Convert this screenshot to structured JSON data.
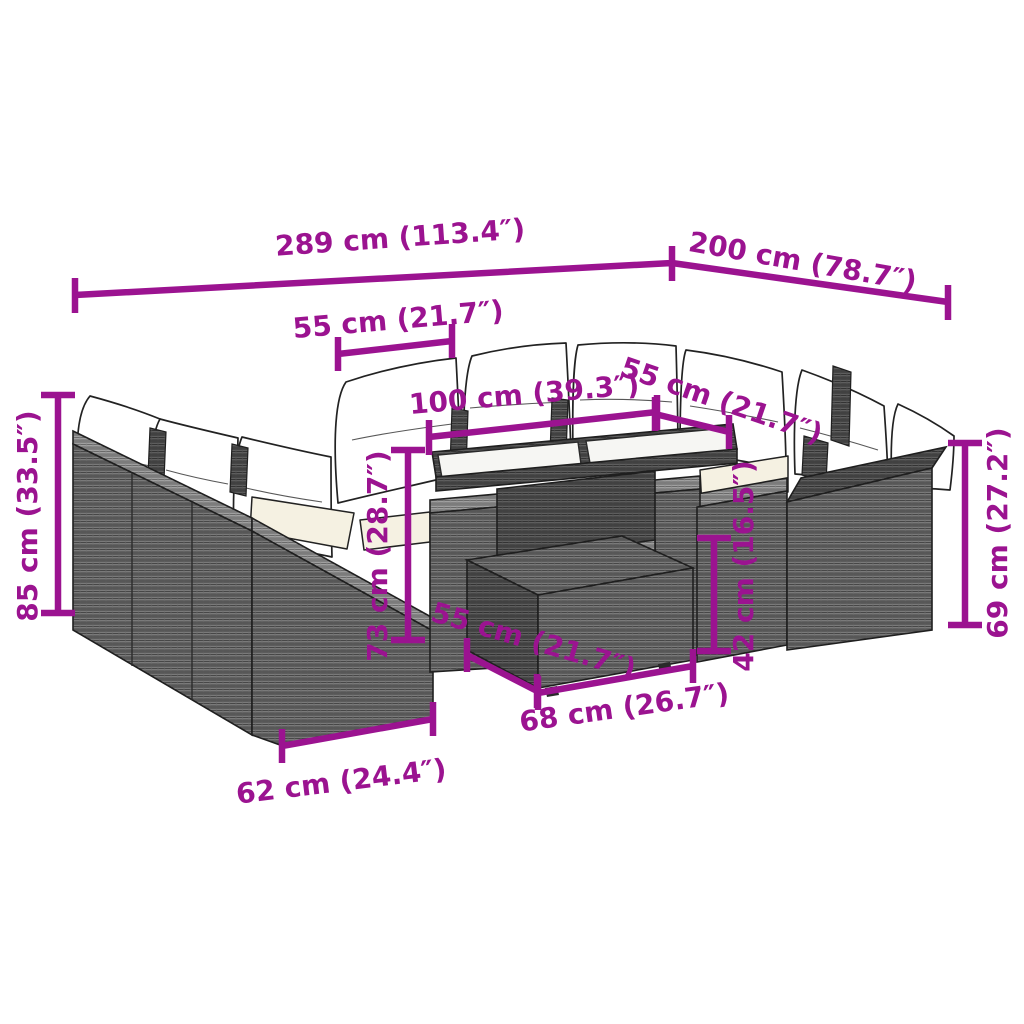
{
  "figure": {
    "subject": "Garden lounge furniture set dimension diagram"
  },
  "colors": {
    "dimension": "#9B1390",
    "background": "#ffffff",
    "outline": "#1f1f1f",
    "rattan_dark": "#4f4f4f",
    "rattan_mid": "#676767",
    "rattan_light": "#8d8d8d",
    "cushion_white": "#ffffff",
    "cushion_cream": "#f5f1e2",
    "glass": "#f6f6f3"
  },
  "dimensions": {
    "overall_length": "289 cm (113.4″)",
    "overall_depth": "200 cm (78.7″)",
    "back_module_width": "55 cm (21.7″)",
    "table_length": "100 cm (39.3″)",
    "right_module_width": "55 cm (21.7″)",
    "backrest_height": "85 cm (33.5″)",
    "table_height": "73 cm (28.7″)",
    "ottoman_height": "42 cm (16.5″)",
    "side_table_height": "69 cm (27.2″)",
    "ottoman_depth": "55 cm (21.7″)",
    "ottoman_width": "68 cm (26.7″)",
    "end_module_width": "62 cm (24.4″)"
  }
}
